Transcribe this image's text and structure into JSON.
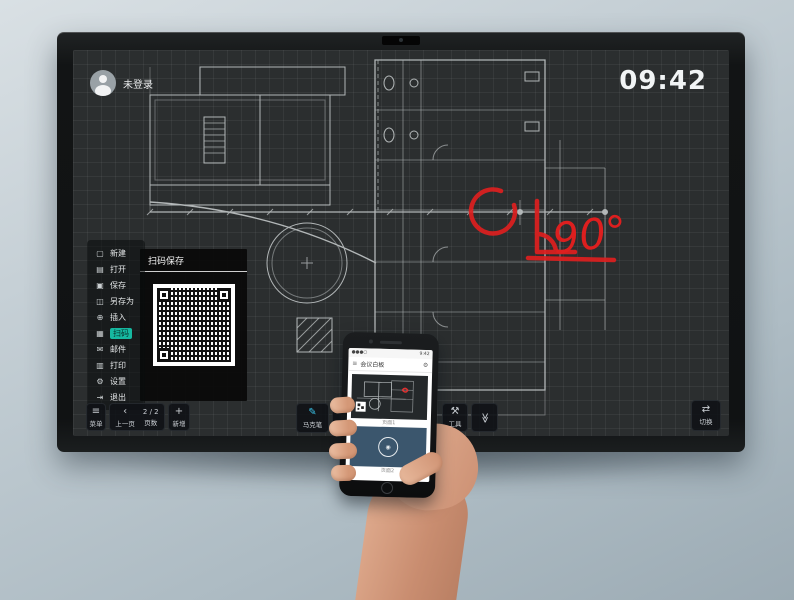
{
  "display": {
    "user_badge": {
      "label": "未登录"
    },
    "clock": "09:42",
    "menu": {
      "items": [
        {
          "label": "新建",
          "icon": "new-file-icon"
        },
        {
          "label": "打开",
          "icon": "open-folder-icon"
        },
        {
          "label": "保存",
          "icon": "save-icon"
        },
        {
          "label": "另存为",
          "icon": "save-as-icon"
        },
        {
          "label": "插入",
          "icon": "insert-icon"
        },
        {
          "label": "扫码",
          "icon": "qr-scan-icon",
          "active": true
        },
        {
          "label": "邮件",
          "icon": "mail-icon"
        },
        {
          "label": "打印",
          "icon": "print-icon"
        },
        {
          "label": "设置",
          "icon": "settings-gear-icon"
        },
        {
          "label": "退出",
          "icon": "exit-icon"
        }
      ]
    },
    "qr_panel": {
      "title": "扫码保存"
    },
    "toolbar": {
      "menu": {
        "label": "菜单",
        "icon": "hamburger-icon"
      },
      "prev": {
        "label": "上一页",
        "icon": "chevron-left-icon"
      },
      "pages": {
        "value": "2 / 2",
        "label": "页数"
      },
      "add": {
        "label": "新增",
        "icon": "plus-icon"
      },
      "pen": {
        "label": "马克笔",
        "icon": "pen-icon"
      },
      "eraser": {
        "label": "板擦",
        "icon": "eraser-icon"
      },
      "tools": {
        "label": "工具",
        "icon": "tools-icon"
      },
      "collapse": {
        "icon": "double-chevron-down-icon"
      },
      "switch": {
        "label": "切换",
        "icon": "switch-arrows-icon"
      }
    },
    "annotation": {
      "text": "90°",
      "color": "#dd1f1f"
    }
  },
  "phone": {
    "status": {
      "time": "9:42",
      "signal": "●●●○"
    },
    "header": {
      "title": "会议白板"
    },
    "pages": [
      {
        "label": "页面1"
      },
      {
        "label": "页面2"
      }
    ]
  },
  "colors": {
    "accent_teal": "#16b8a0",
    "annotation_red": "#dd1f1f",
    "pen_cyan": "#3ac3e8",
    "phone_card_navy": "#3b566d"
  }
}
